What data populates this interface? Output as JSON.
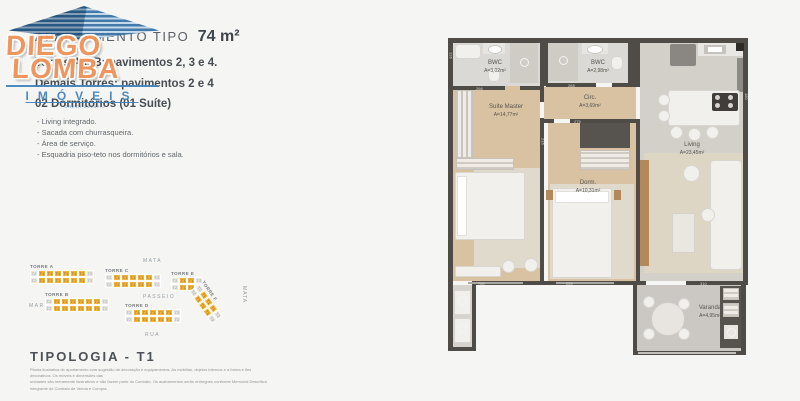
{
  "header": {
    "title_prefix": "APARTAMENTO TIPO",
    "title_area": "74 m²",
    "line1": "Torres A e B: pavimentos 2, 3 e 4.",
    "line2": "Demais Torres: pavimentos 2 e 4",
    "line3": "02 Dormitórios (01 Suíte)"
  },
  "features": [
    "- Living integrado.",
    "- Sacada com churrasqueira.",
    "- Área de serviço.",
    "- Esquadria piso-teto nos dormitórios e sala."
  ],
  "logo": {
    "word1": "DIEGO",
    "word2": "LOMBA",
    "word3": "IMÓVEIS",
    "creci": "CRECI 29147-J"
  },
  "siteplan": {
    "areas": {
      "top": "MATA",
      "left": "MAR",
      "center": "PASSEIO",
      "bottom": "RUA",
      "right": "MATA"
    },
    "towers": [
      {
        "name": "TORRE A",
        "cols": 8
      },
      {
        "name": "TORRE C",
        "cols": 7
      },
      {
        "name": "TORRE E",
        "cols": 4
      },
      {
        "name": "TORRE B",
        "cols": 8
      },
      {
        "name": "TORRE D",
        "cols": 7
      },
      {
        "name": "TORRE F",
        "cols": 5
      }
    ],
    "unit_highlight": "T1",
    "unit_other": "T2"
  },
  "typology": {
    "label": "TIPOLOGIA - T1"
  },
  "disclaimer": {
    "line1": "Planta ilustrativa do apartamento com sugestão de decoração e equipamentos. As mobílias, objetos internos e a forma e fins decorativos. Os móveis e dimensões das",
    "line2": "unidades são meramente ilustrativos e não fazem parte do Contrato. Os acabamentos serão entregues conforme Memorial Descritivo integrante do Contrato de Venda e Compra."
  },
  "plan": {
    "rooms": [
      {
        "name": "BWC",
        "area": "A=3,02m²"
      },
      {
        "name": "BWC",
        "area": "A=2,98m²"
      },
      {
        "name": "Suíte Master",
        "area": "A=14,77m²"
      },
      {
        "name": "Circ.",
        "area": "A=3,69m²"
      },
      {
        "name": "Dorm.",
        "area": "A=10,31m²"
      },
      {
        "name": "Living",
        "area": "A=23,45m²"
      },
      {
        "name": "Varanda",
        "area": "A=4,95m²"
      }
    ],
    "dims": [
      "126",
      "266",
      "268",
      "275",
      "216",
      "180",
      "760",
      "255",
      "310"
    ]
  },
  "colors": {
    "accent_orange": "#ef9157",
    "brand_blue": "#4485bd",
    "site_yellow": "#f2b33b",
    "wall": "#4f4b47",
    "wood_floor": "#d8c2a1"
  }
}
